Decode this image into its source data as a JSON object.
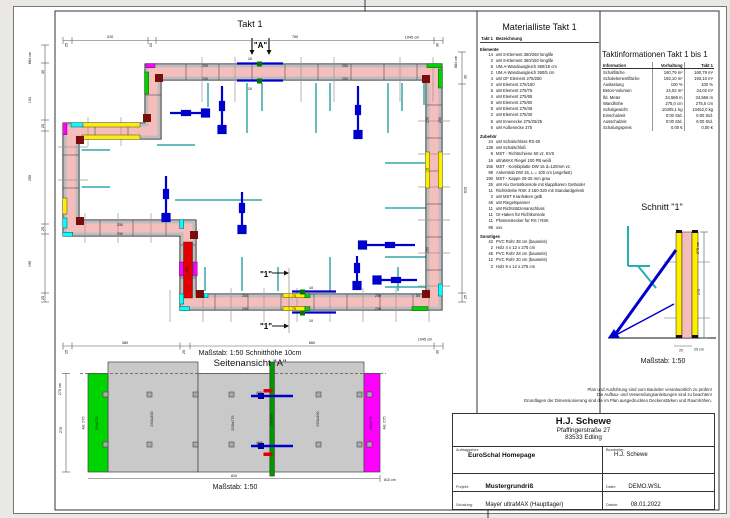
{
  "colors": {
    "wall_pink": "#f6bdbd",
    "formwork_gray": "#bdbdbd",
    "accent_yellow": "#ffee00",
    "accent_green": "#00d400",
    "accent_cyan": "#00ffff",
    "accent_magenta": "#ff00ff",
    "accent_red": "#e00000",
    "corner_darkred": "#7a0c0c",
    "prop_blue": "#0000cd",
    "rail_teal": "#35a8a8"
  },
  "plan": {
    "title": "Takt 1",
    "caption": "Maßstab: 1:50   Schnitthöhe 10cm",
    "labels": {
      "t_25": "25",
      "t_310": "310",
      "t_20": "20",
      "t_760": "760",
      "t_30": "30",
      "t_total": "1045 cm",
      "l_total": "884 cm",
      "l_30": "30",
      "l_134": "134",
      "l_25": "25",
      "l_255": "255",
      "l_195": "195",
      "r_total": "884 cm",
      "r_30": "30",
      "r_629": "629",
      "r_25": "25",
      "b_25": "25",
      "b_380": "380",
      "b_660": "660",
      "b_30": "30",
      "b_total": "1045 cm",
      "e_250": "250",
      "e_50": "50",
      "e_75": "75",
      "e_150": "150",
      "e_15": "15",
      "e_10": "10",
      "a_marker": "\"A\"",
      "s_marker": "\"1\""
    }
  },
  "materialliste": {
    "title": "Materialliste  Takt 1",
    "col_qty": "Takt 1",
    "col_name": "Bezeichnung",
    "groups": [
      {
        "name": "Elemente",
        "items": [
          {
            "q": "14",
            "n": "uM S-Element 360/250 longlife"
          },
          {
            "q": "2",
            "n": "uM S-Element 360/150 longlife"
          },
          {
            "q": "6",
            "n": "UM A-Wandausgleich 360/15 cm"
          },
          {
            "q": "2",
            "n": "UM A-Wandausgleich 360/5 cm"
          },
          {
            "q": "4",
            "n": "uM GF Element 275/250"
          },
          {
            "q": "2",
            "n": "uM Element 275/150"
          },
          {
            "q": "6",
            "n": "uM Element 275/75"
          },
          {
            "q": "4",
            "n": "uM Element 275/65"
          },
          {
            "q": "8",
            "n": "uM Element 275/60"
          },
          {
            "q": "8",
            "n": "uM Element 275/45"
          },
          {
            "q": "2",
            "n": "uM Element 275/30"
          },
          {
            "q": "8",
            "n": "uM Innenecke 275/25/25"
          },
          {
            "q": "6",
            "n": "uM Außenecke 275"
          }
        ]
      },
      {
        "name": "Zubehör",
        "items": [
          {
            "q": "24",
            "n": "uM Schalschloss RS 60"
          },
          {
            "q": "138",
            "n": "uM Schalschloß"
          },
          {
            "q": "8",
            "n": "MST - Richtschiene 50 vz. EVS"
          },
          {
            "q": "16",
            "n": "ultraMAX Riegel 100 PB weiß"
          },
          {
            "q": "156",
            "n": "MST - Kombiplatte DW 15 d=120mm vz."
          },
          {
            "q": "99",
            "n": "Ankerstab DW 15, L = 100 cm (angefast)"
          },
          {
            "q": "190",
            "n": "MST - Kappe 28-25 mm grau"
          },
          {
            "q": "25",
            "n": "uM Alu Gerüstkonsole mit klappbarem Geländer"
          },
          {
            "q": "11",
            "n": "Richtstrebe RSK 3 160-320 mit Standardgelenk"
          },
          {
            "q": "2",
            "n": "uM MST Kranhaken gelb"
          },
          {
            "q": "48",
            "n": "uM Riegelspanner"
          },
          {
            "q": "11",
            "n": "uM Richtstützenanschluss"
          },
          {
            "q": "11",
            "n": "GI-Haken für Richtkonsole"
          },
          {
            "q": "11",
            "n": "Pfostenstecker für RS / RSK"
          },
          {
            "q": "99",
            "n": "xxx"
          }
        ]
      },
      {
        "name": "Sonstiges",
        "items": [
          {
            "q": "42",
            "n": "PVC Rohr 38 cm (bauseits)"
          },
          {
            "q": "2",
            "n": "Holz 4 x 12 x 275 cm"
          },
          {
            "q": "45",
            "n": "PVC Rohr 28 cm (bauseits)"
          },
          {
            "q": "12",
            "n": "PVC Rohr 20 cm (bauseits)"
          },
          {
            "q": "2",
            "n": "Holz 9 x 12 x 275 cm"
          }
        ]
      }
    ]
  },
  "taktinfo": {
    "title": "Taktinformationen  Takt 1 bis 1",
    "headers": [
      "Information",
      "Vorhaltung",
      "Takt 1"
    ],
    "rows": [
      {
        "label": "Schalfläche",
        "a": "160,79 m²",
        "b": "160,79 m²"
      },
      {
        "label": "Schalelementfläche",
        "a": "193,10 m²",
        "b": "193,10 m²"
      },
      {
        "label": "Auslastung",
        "a": "100 %",
        "b": "100 %"
      },
      {
        "label": "Beton-Volumen",
        "a": "24,02 m³",
        "b": "24,02 m³"
      },
      {
        "label": "lfd. Meter",
        "a": "34,566 m",
        "b": "34,566 m"
      },
      {
        "label": "Wandhöhe",
        "a": "275,0 cm",
        "b": "275,0 cm"
      },
      {
        "label": "Schalgewicht",
        "a": "10405,1 kg",
        "b": "10452,0 kg"
      },
      {
        "label": "Einschalzeit",
        "a": "0:00 Std.",
        "b": "6:00 Std."
      },
      {
        "label": "Ausschalzeit",
        "a": "0:00 Std.",
        "b": "6:00 Std."
      },
      {
        "label": "Schalungspreis",
        "a": "0,00 €",
        "b": "0,00 €"
      }
    ]
  },
  "schnitt": {
    "title": "Schnitt \"1\"",
    "scale": "Maßstab: 1:50",
    "labels": {
      "h_total": "275 cm",
      "h": "275",
      "w20": "20",
      "w25": "25 cm"
    }
  },
  "seitenansicht": {
    "title": "Seitenansicht \"A\"",
    "scale": "Maßstab: 1:50",
    "labels": {
      "h_total": "270 cm",
      "h": "270",
      "w": "810",
      "w_total": "810 cm",
      "ae": "AE 275",
      "p55": "55x275",
      "p250": "250x300",
      "p200": "200x275",
      "p10": "10x300",
      "p45": "45x275"
    }
  },
  "disclaimer": {
    "line1": "Plan und Ausführung sind vom Bauleiter verantwortlich zu prüfen!",
    "line2": "Die Aufbau- und Verwendungsanleitungen sind zu beachten!",
    "line3": "Grundlagen der Dimensionierung sind die im Plan ausgedruckten Deckenstärken und Raumhöhen."
  },
  "titleblock": {
    "company": "H.J. Schewe",
    "street": "Pfaffingerstraße 27",
    "city": "83533 Edling",
    "cap_client": "Auftraggeber:",
    "client": "EuroSchal Homepage",
    "cap_editor": "Bearbeiter:",
    "editor": "H.J. Schewe",
    "cap_project": "Projekt:",
    "project": "Mustergrundriß",
    "cap_file": "Datei:",
    "file": "DEMO.WSL",
    "cap_formwork": "Schalung:",
    "formwork": "Mayer ultraMAX (Hauptlager)",
    "cap_date": "Datum:",
    "date": "08.01.2022"
  }
}
